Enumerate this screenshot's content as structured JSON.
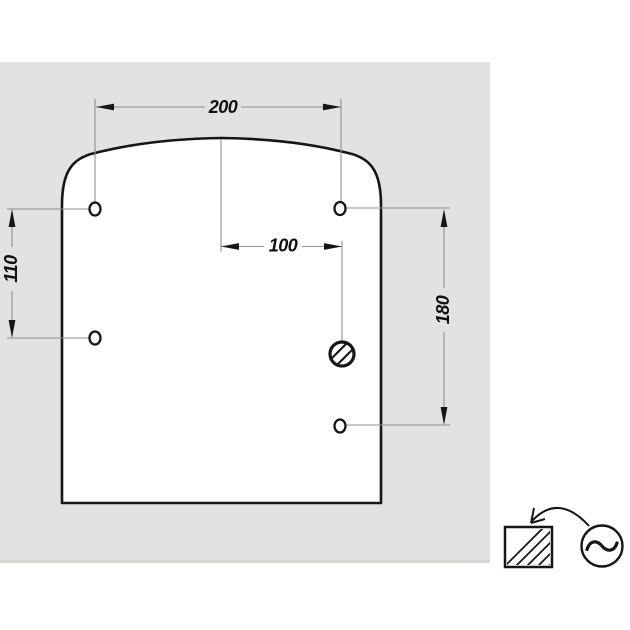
{
  "colors": {
    "canvas_bg": "#e2e2e0",
    "canvas_bottom_edge": "#d6d6d3",
    "outline": "#161616",
    "dim_line": "#8f8f8f",
    "label": "#101010"
  },
  "drawing": {
    "dimension_labels": {
      "top_width": "200",
      "center_to_socket": "100",
      "left_hole_spacing": "110",
      "right_hole_spacing": "180"
    },
    "mounting_hole_count": "4"
  },
  "legend": {
    "panel_symbol": "hatched-square-icon",
    "power_symbol": "ac-source-icon",
    "arrow_symbol": "curved-arrow-icon"
  }
}
